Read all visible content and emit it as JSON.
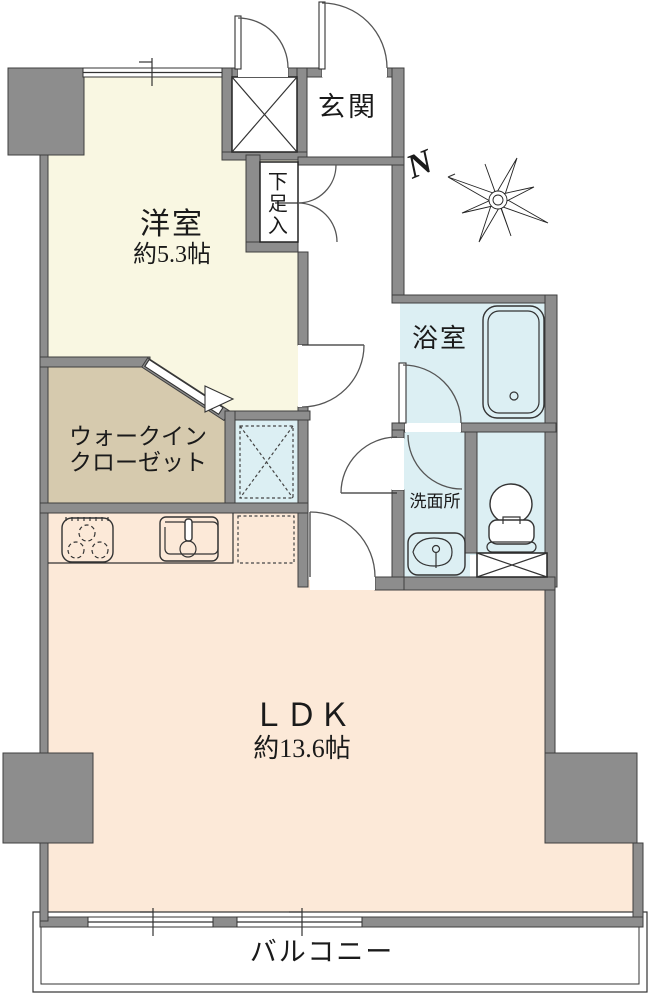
{
  "floorplan": {
    "title": "apartment-floor-plan",
    "rooms": {
      "western_room": {
        "name": "洋室",
        "area": "約5.3帖"
      },
      "walk_in_closet": {
        "name_line1": "ウォークイン",
        "name_line2": "クローゼット"
      },
      "ldk": {
        "name": "ＬＤＫ",
        "area": "約13.6帖"
      },
      "bathroom": {
        "name": "浴室"
      },
      "washroom": {
        "name": "洗面所"
      },
      "entrance": {
        "name": "玄関"
      },
      "shoe_cabinet": {
        "name": "下足入"
      },
      "balcony": {
        "name": "バルコニー"
      }
    },
    "compass": {
      "north_label": "N"
    },
    "colors": {
      "wall": "#8d8d8d",
      "outline": "#3f3f3f",
      "western-room": "#f9f7e2",
      "closet": "#d6caae",
      "ldk": "#fce9d8",
      "wet-area": "#dceff3"
    }
  }
}
